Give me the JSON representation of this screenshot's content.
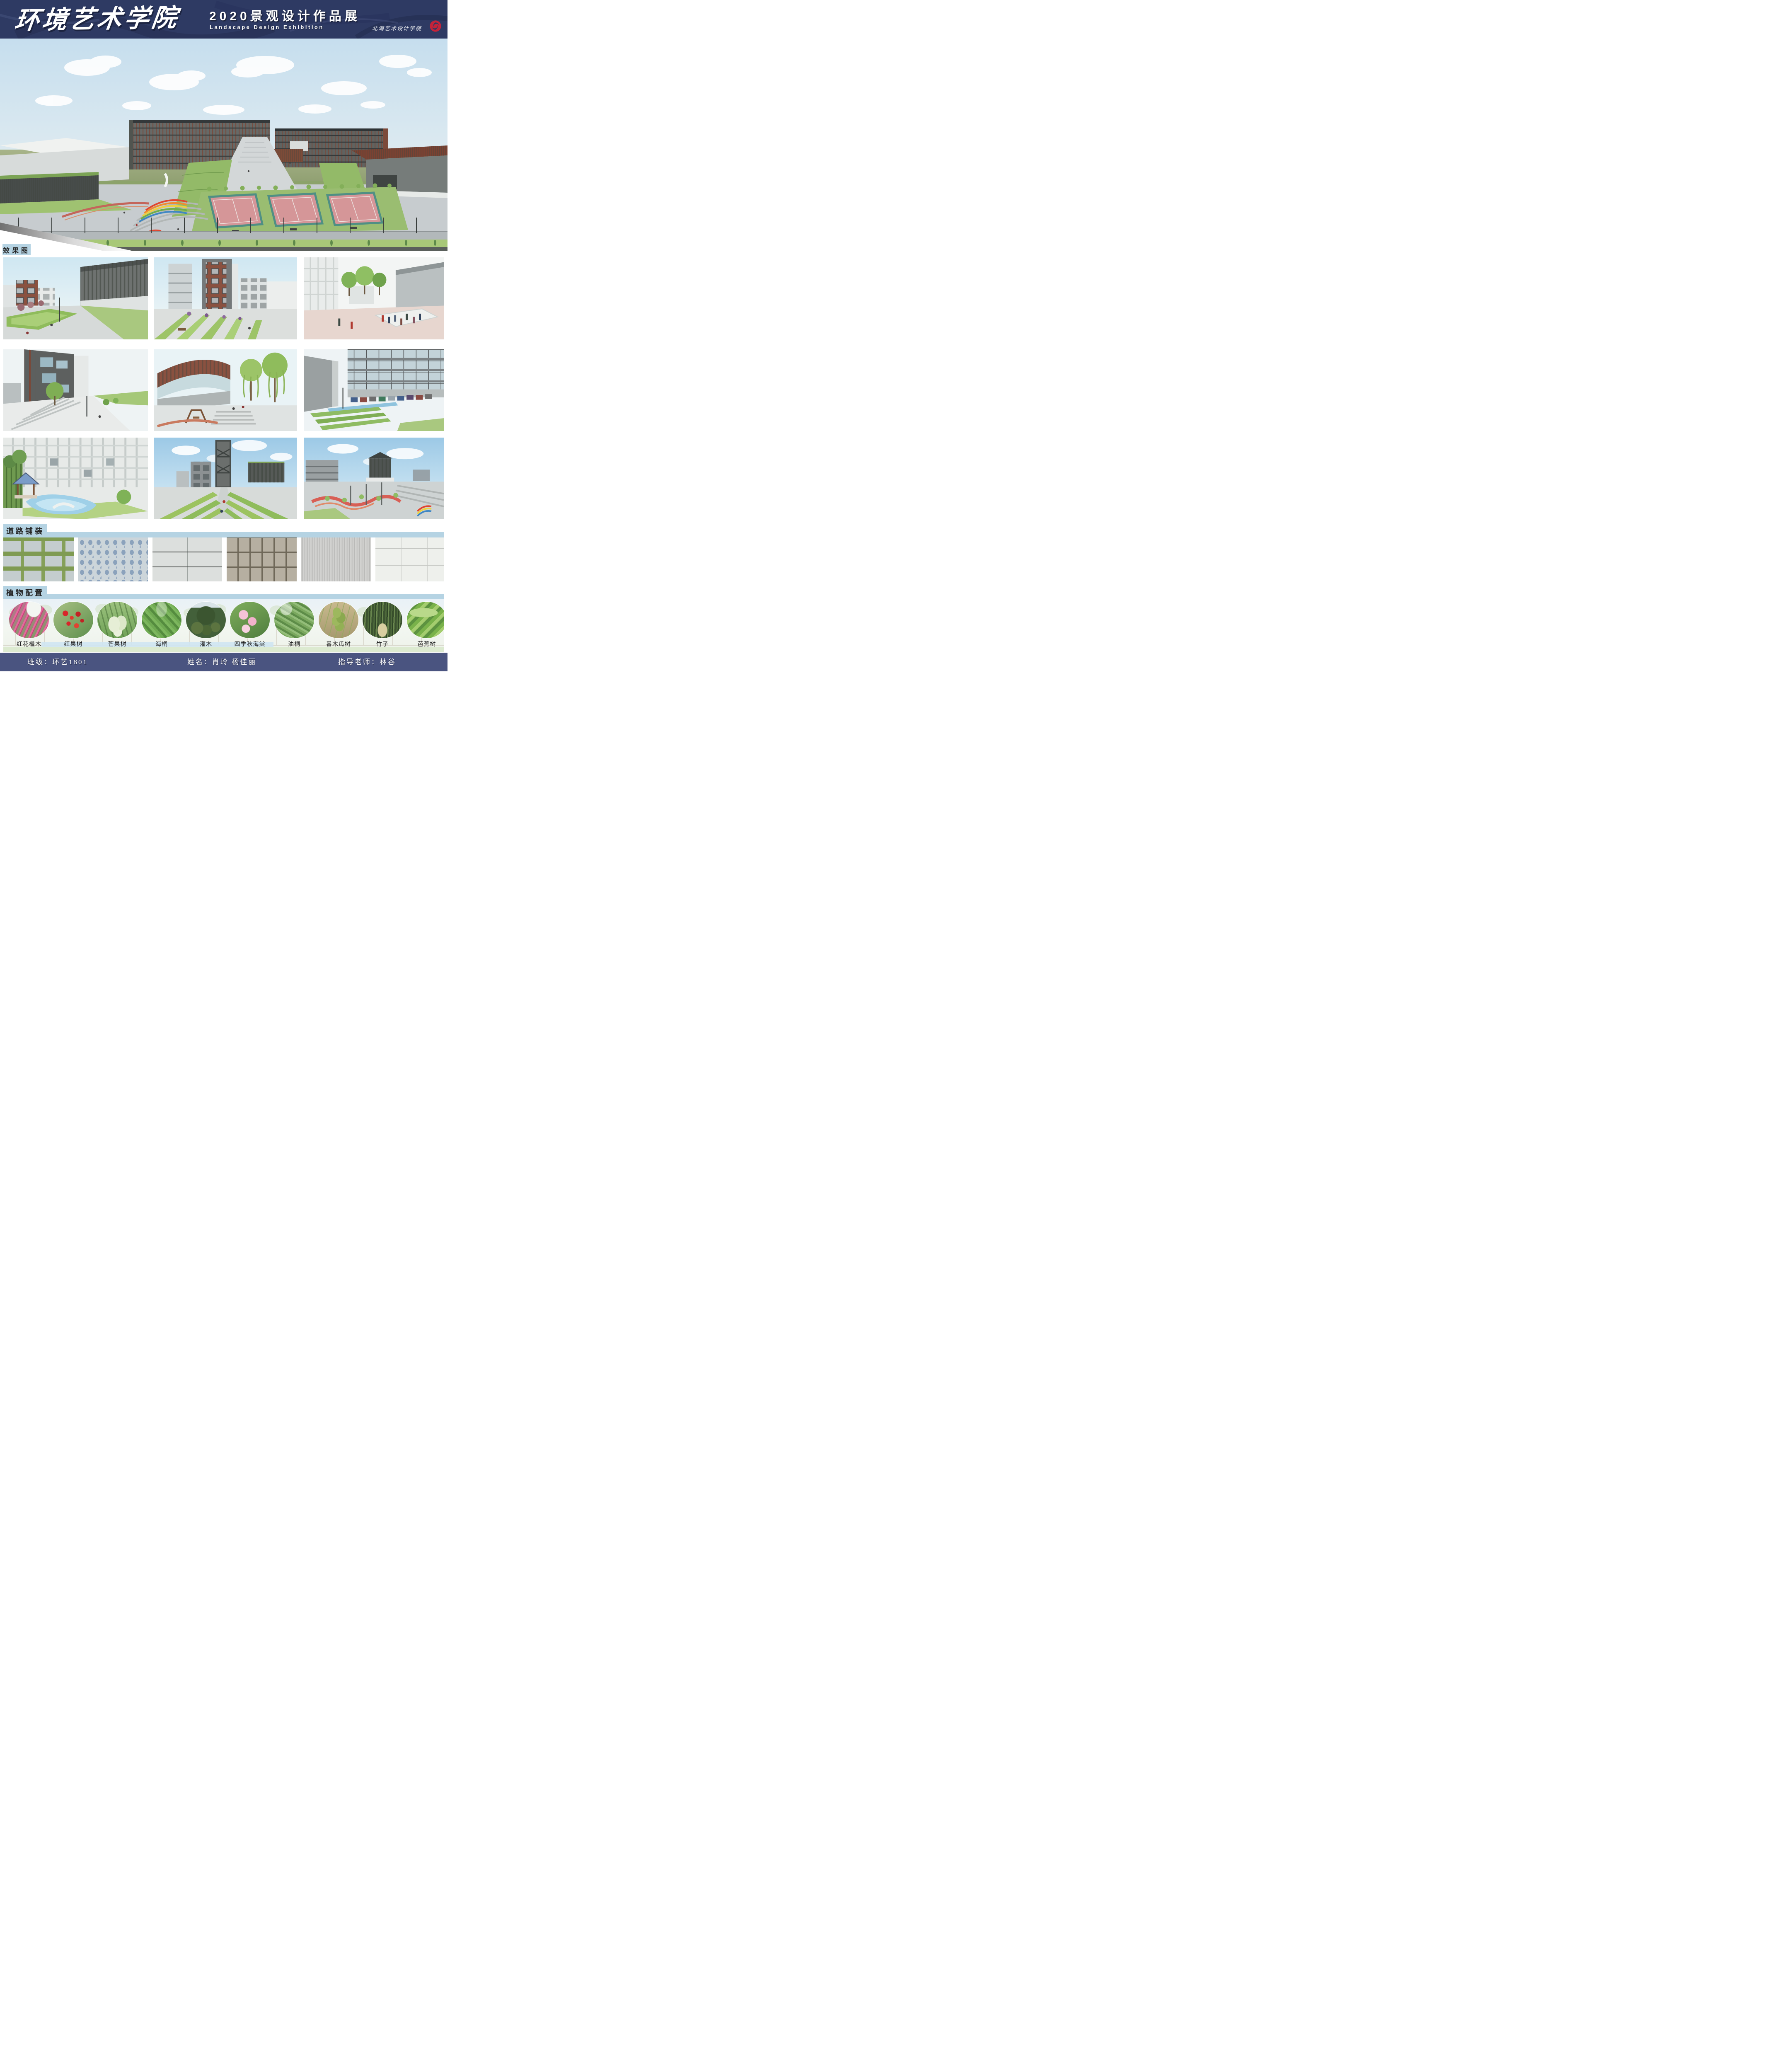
{
  "header": {
    "title": "环境艺术学院",
    "subtitle_cn": "2020景观设计作品展",
    "subtitle_en": "Landscape Design Exhibition",
    "seal_text": "北海艺术设计学院",
    "bg_color": "#2e3a63",
    "seal_color": "#c4233a"
  },
  "section_labels": {
    "renderings": "效果图",
    "paving": "道路铺装",
    "plants": "植物配置",
    "label_bg": "#b5d3e3"
  },
  "paving_swatches": [
    {
      "name": "grass-joint-pavers",
      "base": "#c4cdce",
      "accent": "#7f9b52"
    },
    {
      "name": "blue-pebble-mosaic",
      "base": "#ccd5da",
      "accent": "#8ba2bc"
    },
    {
      "name": "gray-granite-tiles",
      "base": "#dcdfdd",
      "accent": "#4e514f"
    },
    {
      "name": "tan-square-pavers",
      "base": "#b6afa1",
      "accent": "#6f6859"
    },
    {
      "name": "striated-stone",
      "base": "#c8c8c6",
      "accent": "#a3a3a1"
    },
    {
      "name": "white-speckled-tiles",
      "base": "#eef0ec",
      "accent": "#c6c8c4"
    }
  ],
  "plants": {
    "items": [
      {
        "name": "红花檵木"
      },
      {
        "name": "红果树"
      },
      {
        "name": "芒果树"
      },
      {
        "name": "海桐"
      },
      {
        "name": "灌木"
      },
      {
        "name": "四季秋海棠"
      },
      {
        "name": "油桐"
      },
      {
        "name": "番木瓜树"
      },
      {
        "name": "竹子"
      },
      {
        "name": "芭蕉树"
      }
    ]
  },
  "footer": {
    "class_info": "班级：环艺1801",
    "names_info": "姓名：肖玲 杨佳丽",
    "advisor_info": "指导老师：林谷",
    "bg_color": "#4a5480"
  }
}
